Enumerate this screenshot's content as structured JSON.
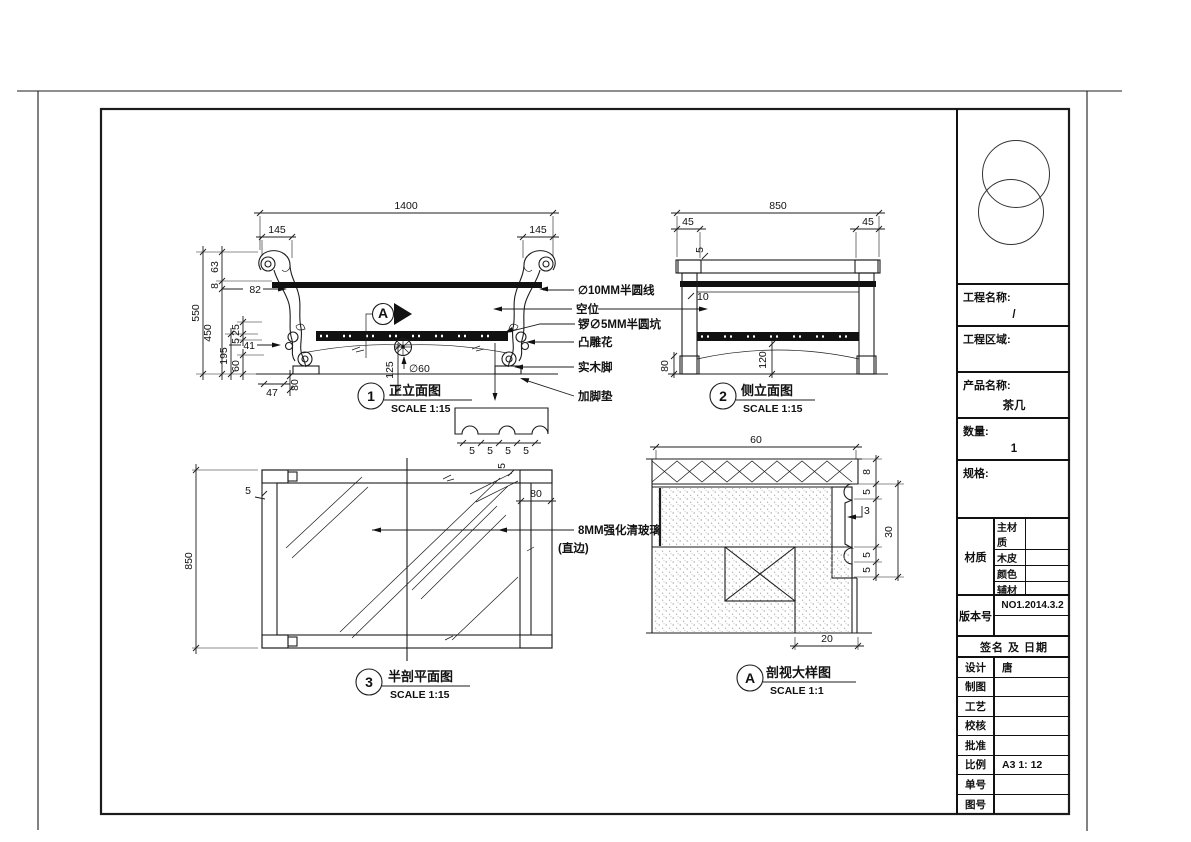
{
  "views": {
    "front": {
      "badge": "1",
      "title": "正立面图",
      "scale": "SCALE 1:15",
      "dims": {
        "width": "1400",
        "overhang_l": "145",
        "overhang_r": "145",
        "height": "550",
        "h63": "63",
        "h8": "8",
        "h450": "450",
        "h195": "195",
        "h25": "25",
        "h5": "5",
        "h60": "60",
        "lead82": "82",
        "lead41": "41",
        "w47": "47",
        "h80": "80",
        "h125": "125",
        "dia60": "∅60"
      },
      "marker": "A",
      "callouts": [
        "∅10MM半圆线",
        "空位",
        "锣∅5MM半圆坑",
        "凸雕花",
        "实木脚",
        "加脚垫"
      ],
      "groove_dims": [
        "5",
        "5",
        "5",
        "5"
      ]
    },
    "side": {
      "badge": "2",
      "title": "侧立面图",
      "scale": "SCALE 1:15",
      "dims": {
        "width": "850",
        "o45l": "45",
        "o45r": "45",
        "t5": "5",
        "t10": "10",
        "h80": "80",
        "h120": "120"
      }
    },
    "plan": {
      "badge": "3",
      "title": "半剖平面图",
      "scale": "SCALE 1:15",
      "dims": {
        "depth": "850",
        "e5a": "5",
        "e5b": "5",
        "w80": "80"
      },
      "glass_line1": "8MM强化清玻璃",
      "glass_line2": "(直边)"
    },
    "detail": {
      "badge": "A",
      "title": "剖视大样图",
      "scale": "SCALE 1:1",
      "dims": {
        "w60": "60",
        "h8": "8",
        "h5a": "5",
        "s3": "3",
        "h30": "30",
        "h5b": "5",
        "h5c": "5",
        "w20": "20"
      }
    }
  },
  "titleblock": {
    "project_label": "工程名称:",
    "project_value": "/",
    "area_label": "工程区域:",
    "product_label": "产品名称:",
    "product_value": "茶几",
    "qty_label": "数量:",
    "qty_value": "1",
    "spec_label": "规格:",
    "material_label": "材质",
    "material_rows": [
      "主材质",
      "木皮",
      "颜色",
      "辅材"
    ],
    "version_label": "版本号",
    "version_value": "NO1.2014.3.2",
    "sign_header": "签名 及 日期",
    "rows": [
      {
        "label": "设计",
        "value": "唐"
      },
      {
        "label": "制图",
        "value": ""
      },
      {
        "label": "工艺",
        "value": ""
      },
      {
        "label": "校核",
        "value": ""
      },
      {
        "label": "批准",
        "value": ""
      },
      {
        "label": "比例",
        "value": "A3 1: 12"
      },
      {
        "label": "单号",
        "value": ""
      },
      {
        "label": "图号",
        "value": ""
      }
    ]
  }
}
